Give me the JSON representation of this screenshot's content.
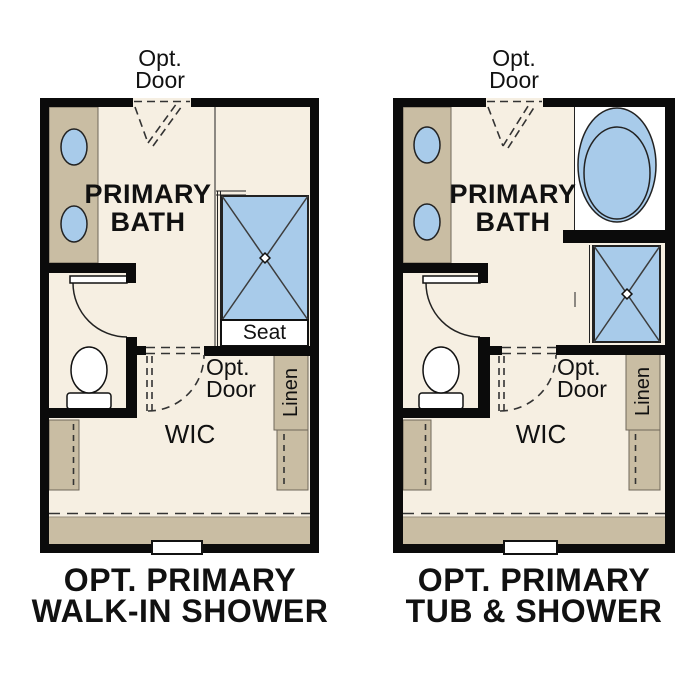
{
  "colors": {
    "wall": "#0b0b0b",
    "floor": "#f6efe2",
    "cabinet": "#c9bda3",
    "fixture_blue": "#a8cbea",
    "outline": "#222222",
    "dash": "#333333",
    "text": "#111111"
  },
  "plans": [
    {
      "name": "walk-in-shower-option",
      "top_door": {
        "line1": "Opt.",
        "line2": "Door"
      },
      "room": {
        "line1": "PRIMARY",
        "line2": "BATH"
      },
      "shower_seat": "Seat",
      "mid_door": {
        "line1": "Opt.",
        "line2": "Door"
      },
      "closet": "Linen",
      "wic": "WIC",
      "title": {
        "line1": "OPT. PRIMARY",
        "line2": "WALK-IN SHOWER"
      }
    },
    {
      "name": "tub-and-shower-option",
      "top_door": {
        "line1": "Opt.",
        "line2": "Door"
      },
      "room": {
        "line1": "PRIMARY",
        "line2": "BATH"
      },
      "mid_door": {
        "line1": "Opt.",
        "line2": "Door"
      },
      "closet": "Linen",
      "wic": "WIC",
      "title": {
        "line1": "OPT. PRIMARY",
        "line2": "TUB & SHOWER"
      }
    }
  ]
}
